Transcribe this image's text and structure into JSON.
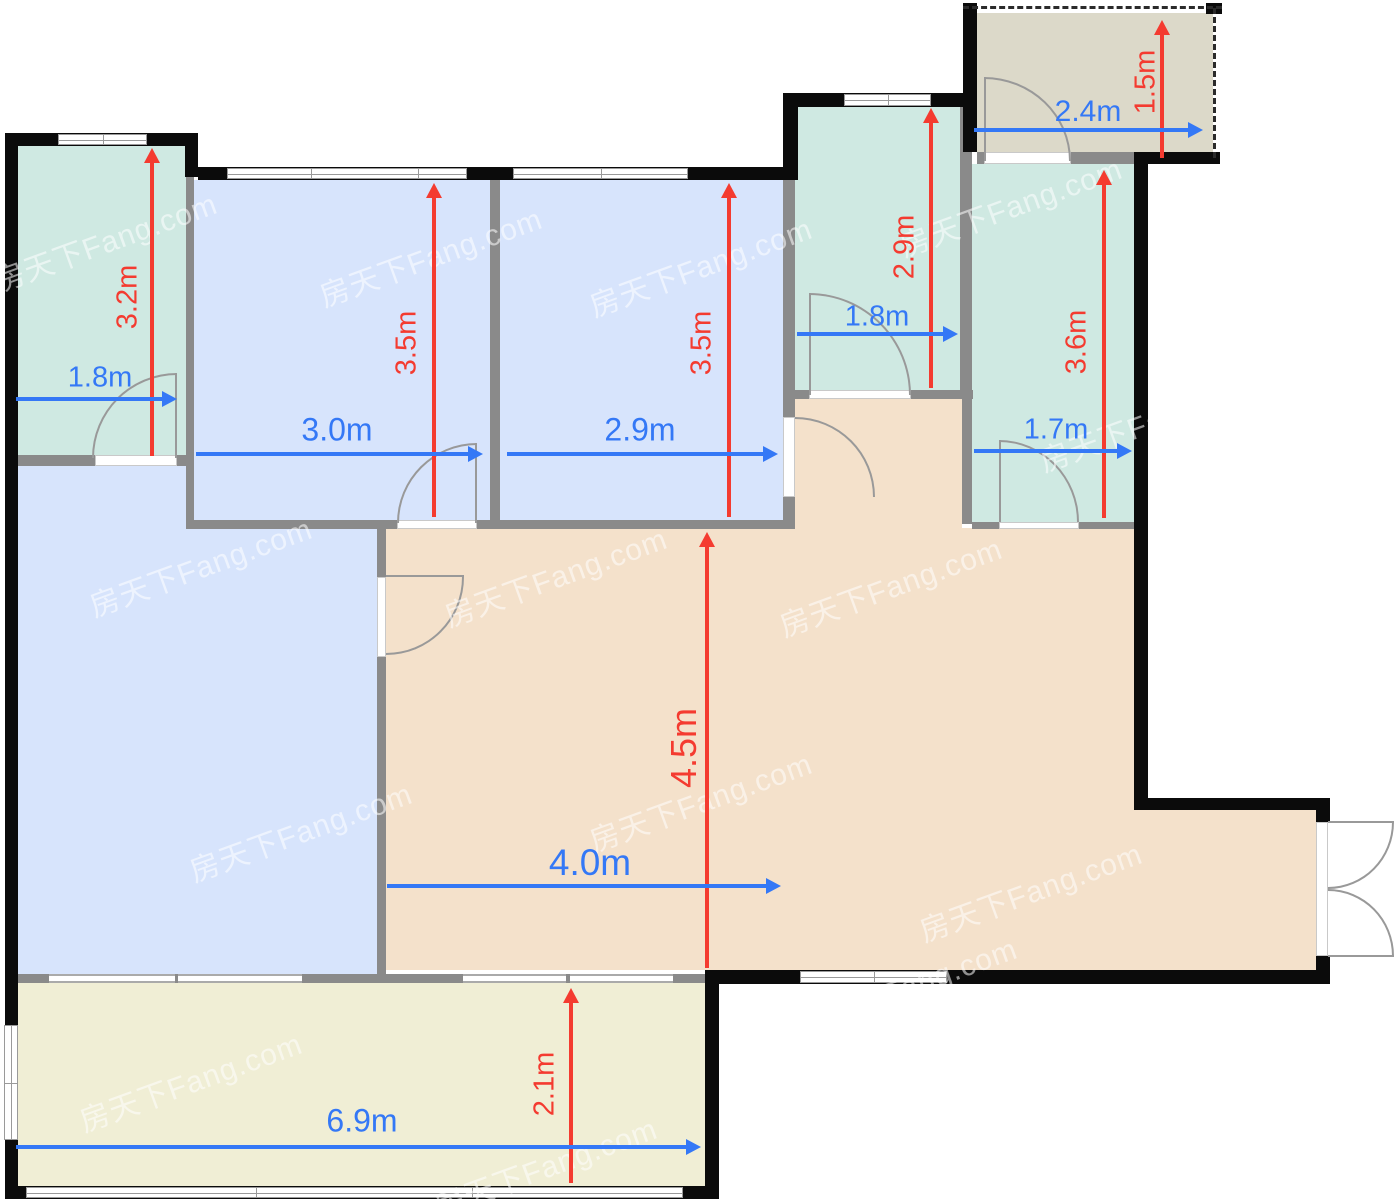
{
  "title": "apartment-floor-plan",
  "watermark": {
    "text": "房天下Fang.com",
    "positions": [
      [
        105,
        240
      ],
      [
        430,
        255
      ],
      [
        700,
        265
      ],
      [
        1010,
        205
      ],
      [
        1150,
        420
      ],
      [
        200,
        565
      ],
      [
        555,
        575
      ],
      [
        890,
        585
      ],
      [
        300,
        830
      ],
      [
        700,
        800
      ],
      [
        1030,
        890
      ],
      [
        190,
        1080
      ],
      [
        545,
        1165
      ],
      [
        905,
        985
      ]
    ]
  },
  "palette": {
    "teal": "#cfe9e2",
    "blue": "#d7e4fc",
    "tan": "#f4e1cb",
    "yellow": "#f0eed5",
    "gray": "#dcd9c9",
    "wall_black": "#0b0b0b",
    "wall_gray": "#8a8a8a",
    "dim_red": "#f43b30",
    "dim_blue": "#3478f6"
  },
  "plan": {
    "width": 1400,
    "height": 1199,
    "rooms": [
      {
        "n": "room-north-bedroom",
        "x": 18,
        "y": 146,
        "w": 168,
        "h": 309,
        "c": "teal"
      },
      {
        "n": "room-bedroom-1",
        "x": 194,
        "y": 180,
        "w": 296,
        "h": 340,
        "c": "blue"
      },
      {
        "n": "room-bedroom-2",
        "x": 500,
        "y": 180,
        "w": 283,
        "h": 340,
        "c": "blue"
      },
      {
        "n": "room-bathroom-a",
        "x": 795,
        "y": 107,
        "w": 165,
        "h": 283,
        "c": "teal"
      },
      {
        "n": "room-entry-porch",
        "x": 977,
        "y": 13,
        "w": 236,
        "h": 139,
        "c": "gray"
      },
      {
        "n": "room-bathroom-b",
        "x": 972,
        "y": 164,
        "w": 162,
        "h": 358,
        "c": "teal"
      },
      {
        "n": "room-living-west",
        "x": 18,
        "y": 465,
        "w": 168,
        "h": 510,
        "c": "blue"
      },
      {
        "n": "room-living-west2",
        "x": 186,
        "y": 529,
        "w": 191,
        "h": 446,
        "c": "blue"
      },
      {
        "n": "room-hallway",
        "x": 795,
        "y": 399,
        "w": 167,
        "h": 129,
        "c": "tan"
      },
      {
        "n": "room-dining",
        "x": 386,
        "y": 528,
        "w": 748,
        "h": 442,
        "c": "tan"
      },
      {
        "n": "room-dining-east",
        "x": 1134,
        "y": 810,
        "w": 182,
        "h": 160,
        "c": "tan"
      },
      {
        "n": "room-balcony",
        "x": 18,
        "y": 983,
        "w": 687,
        "h": 203,
        "c": "yellow"
      }
    ],
    "walls_gray": [
      {
        "x": 186,
        "y": 177,
        "w": 8,
        "h": 352
      },
      {
        "x": 18,
        "y": 455,
        "w": 77,
        "h": 11
      },
      {
        "x": 177,
        "y": 455,
        "w": 11,
        "h": 11
      },
      {
        "x": 186,
        "y": 520,
        "w": 211,
        "h": 9
      },
      {
        "x": 477,
        "y": 520,
        "w": 15,
        "h": 9
      },
      {
        "x": 490,
        "y": 168,
        "w": 10,
        "h": 361
      },
      {
        "x": 490,
        "y": 520,
        "w": 305,
        "h": 9
      },
      {
        "x": 783,
        "y": 168,
        "w": 12,
        "h": 249
      },
      {
        "x": 783,
        "y": 497,
        "w": 12,
        "h": 31
      },
      {
        "x": 960,
        "y": 107,
        "w": 12,
        "h": 283
      },
      {
        "x": 962,
        "y": 390,
        "w": 10,
        "h": 134
      },
      {
        "x": 783,
        "y": 390,
        "w": 26,
        "h": 9
      },
      {
        "x": 911,
        "y": 390,
        "w": 62,
        "h": 9
      },
      {
        "x": 977,
        "y": 152,
        "w": 7,
        "h": 12
      },
      {
        "x": 1071,
        "y": 152,
        "w": 64,
        "h": 12
      },
      {
        "x": 972,
        "y": 522,
        "w": 27,
        "h": 7
      },
      {
        "x": 1079,
        "y": 522,
        "w": 55,
        "h": 7
      },
      {
        "x": 377,
        "y": 529,
        "w": 9,
        "h": 48
      },
      {
        "x": 377,
        "y": 657,
        "w": 9,
        "h": 318
      },
      {
        "x": 8,
        "y": 974,
        "w": 700,
        "h": 9
      }
    ],
    "walls_black": [
      {
        "x": 5,
        "y": 133,
        "w": 13,
        "h": 1066
      },
      {
        "x": 5,
        "y": 133,
        "w": 193,
        "h": 13
      },
      {
        "x": 185,
        "y": 133,
        "w": 13,
        "h": 44
      },
      {
        "x": 198,
        "y": 167,
        "w": 600,
        "h": 13
      },
      {
        "x": 783,
        "y": 93,
        "w": 15,
        "h": 85
      },
      {
        "x": 790,
        "y": 93,
        "w": 183,
        "h": 14
      },
      {
        "x": 963,
        "y": 3,
        "w": 14,
        "h": 149
      },
      {
        "x": 1134,
        "y": 152,
        "w": 86,
        "h": 12
      },
      {
        "x": 1134,
        "y": 152,
        "w": 14,
        "h": 658
      },
      {
        "x": 1134,
        "y": 798,
        "w": 196,
        "h": 12
      },
      {
        "x": 1316,
        "y": 810,
        "w": 14,
        "h": 12
      },
      {
        "x": 1316,
        "y": 956,
        "w": 14,
        "h": 28
      },
      {
        "x": 705,
        "y": 970,
        "w": 625,
        "h": 14
      },
      {
        "x": 705,
        "y": 970,
        "w": 14,
        "h": 229
      },
      {
        "x": 5,
        "y": 1186,
        "w": 714,
        "h": 13
      },
      {
        "x": 1206,
        "y": 3,
        "w": 16,
        "h": 11
      }
    ],
    "windows": [
      {
        "n": "window-north-bedroom",
        "x": 58,
        "y": 134,
        "w": 89,
        "h": 11,
        "o": "h",
        "div": [
          0.5
        ]
      },
      {
        "n": "window-bedroom-1",
        "x": 227,
        "y": 168,
        "w": 240,
        "h": 11,
        "o": "h",
        "div": [
          0.35,
          0.8
        ]
      },
      {
        "n": "window-bedroom-2",
        "x": 513,
        "y": 168,
        "w": 175,
        "h": 11,
        "o": "h",
        "div": [
          0.5
        ]
      },
      {
        "n": "window-bathroom-a",
        "x": 844,
        "y": 94,
        "w": 87,
        "h": 12,
        "o": "h",
        "div": [
          0.5
        ]
      },
      {
        "n": "window-dining-south",
        "x": 800,
        "y": 971,
        "w": 147,
        "h": 12,
        "o": "h",
        "div": [
          0.5
        ]
      },
      {
        "n": "window-balcony-south",
        "x": 26,
        "y": 1187,
        "w": 657,
        "h": 11,
        "o": "h",
        "div": [
          0.35,
          0.68
        ]
      },
      {
        "n": "window-balcony-west",
        "x": 4,
        "y": 1025,
        "w": 14,
        "h": 115,
        "o": "v",
        "div": [
          0.5
        ]
      }
    ],
    "window_segments": [
      {
        "x": 49,
        "y": 974,
        "w": 126,
        "h": 9
      },
      {
        "x": 178,
        "y": 974,
        "w": 124,
        "h": 9
      },
      {
        "x": 463,
        "y": 974,
        "w": 103,
        "h": 9
      },
      {
        "x": 570,
        "y": 974,
        "w": 103,
        "h": 9
      }
    ],
    "door_openings": [
      {
        "n": "door-opening-north-bedroom",
        "x": 95,
        "y": 455,
        "w": 82,
        "h": 11
      },
      {
        "n": "door-opening-bedroom-1",
        "x": 397,
        "y": 520,
        "w": 80,
        "h": 9
      },
      {
        "n": "door-opening-bedroom-2",
        "x": 783,
        "y": 417,
        "w": 12,
        "h": 80
      },
      {
        "n": "door-opening-bathroom-a",
        "x": 809,
        "y": 390,
        "w": 102,
        "h": 9
      },
      {
        "n": "door-opening-porch",
        "x": 984,
        "y": 152,
        "w": 87,
        "h": 12
      },
      {
        "n": "door-opening-bathroom-b",
        "x": 999,
        "y": 522,
        "w": 80,
        "h": 7
      },
      {
        "n": "door-opening-living",
        "x": 377,
        "y": 577,
        "w": 9,
        "h": 80
      },
      {
        "n": "door-opening-entry",
        "x": 1316,
        "y": 822,
        "w": 12,
        "h": 134
      }
    ],
    "door_arcs": [
      {
        "n": "door-arc-north-bedroom",
        "x": 92,
        "y": 373,
        "w": 85,
        "h": 85,
        "corner": "tl"
      },
      {
        "n": "door-arc-bedroom-1",
        "x": 397,
        "y": 443,
        "w": 80,
        "h": 80,
        "corner": "tl"
      },
      {
        "n": "door-arc-bedroom-2",
        "x": 795,
        "y": 417,
        "w": 80,
        "h": 80,
        "corner": "tr"
      },
      {
        "n": "door-arc-bathroom-a",
        "x": 809,
        "y": 293,
        "w": 102,
        "h": 102,
        "corner": "tr"
      },
      {
        "n": "door-arc-porch",
        "x": 984,
        "y": 77,
        "w": 87,
        "h": 84,
        "corner": "tr"
      },
      {
        "n": "door-arc-bathroom-b",
        "x": 999,
        "y": 440,
        "w": 80,
        "h": 82,
        "corner": "tr"
      },
      {
        "n": "door-arc-living",
        "x": 386,
        "y": 577,
        "w": 78,
        "h": 78,
        "corner": "br"
      },
      {
        "n": "door-arc-entry-top",
        "x": 1328,
        "y": 822,
        "w": 66,
        "h": 67,
        "corner": "br"
      },
      {
        "n": "door-arc-entry-bottom",
        "x": 1328,
        "y": 889,
        "w": 66,
        "h": 67,
        "corner": "tr"
      }
    ],
    "door_panels": [
      {
        "x": 175,
        "y": 373,
        "w": 2,
        "h": 85
      },
      {
        "x": 475,
        "y": 443,
        "w": 2,
        "h": 80
      },
      {
        "x": 809,
        "y": 293,
        "w": 2,
        "h": 102
      },
      {
        "x": 984,
        "y": 77,
        "w": 2,
        "h": 84
      },
      {
        "x": 999,
        "y": 440,
        "w": 2,
        "h": 82
      },
      {
        "x": 386,
        "y": 575,
        "w": 78,
        "h": 2
      },
      {
        "x": 1328,
        "y": 821,
        "w": 66,
        "h": 2
      },
      {
        "x": 1328,
        "y": 955,
        "w": 66,
        "h": 2
      }
    ],
    "dashed_lines": [
      {
        "n": "dashed-porch-top",
        "x": 963,
        "y": 6,
        "len": 259,
        "o": "h"
      },
      {
        "n": "dashed-porch-right",
        "x": 1213,
        "y": 8,
        "len": 150,
        "o": "v"
      }
    ],
    "dimension_arrows": {
      "red": [
        {
          "label": "3.2m",
          "x": 152,
          "y1": 148,
          "y2": 456
        },
        {
          "label": "3.5m",
          "x": 434,
          "y1": 183,
          "y2": 517
        },
        {
          "label": "3.5m",
          "x": 729,
          "y1": 183,
          "y2": 517
        },
        {
          "label": "2.9m",
          "x": 931,
          "y1": 108,
          "y2": 388
        },
        {
          "label": "1.5m",
          "x": 1162,
          "y1": 20,
          "y2": 158
        },
        {
          "label": "3.6m",
          "x": 1104,
          "y1": 170,
          "y2": 518
        },
        {
          "label": "4.5m",
          "x": 707,
          "y1": 532,
          "y2": 968
        },
        {
          "label": "2.1m",
          "x": 571,
          "y1": 988,
          "y2": 1183
        }
      ],
      "blue": [
        {
          "label": "1.8m",
          "y": 399,
          "x1": 16,
          "x2": 177
        },
        {
          "label": "3.0m",
          "y": 454,
          "x1": 196,
          "x2": 483
        },
        {
          "label": "2.9m",
          "y": 454,
          "x1": 507,
          "x2": 778
        },
        {
          "label": "1.8m",
          "y": 334,
          "x1": 797,
          "x2": 958
        },
        {
          "label": "2.4m",
          "y": 130,
          "x1": 974,
          "x2": 1203
        },
        {
          "label": "1.7m",
          "y": 451,
          "x1": 974,
          "x2": 1132
        },
        {
          "label": "4.0m",
          "y": 886,
          "x1": 387,
          "x2": 781
        },
        {
          "label": "6.9m",
          "y": 1147,
          "x1": 16,
          "x2": 701
        }
      ]
    },
    "dimension_labels": [
      {
        "text": "3.2m",
        "x": 128,
        "y": 297,
        "rot": 1,
        "size": 29,
        "color": "red"
      },
      {
        "text": "3.5m",
        "x": 407,
        "y": 343,
        "rot": 1,
        "size": 29,
        "color": "red"
      },
      {
        "text": "3.5m",
        "x": 702,
        "y": 343,
        "rot": 1,
        "size": 29,
        "color": "red"
      },
      {
        "text": "2.9m",
        "x": 905,
        "y": 247,
        "rot": 1,
        "size": 29,
        "color": "red"
      },
      {
        "text": "1.5m",
        "x": 1146,
        "y": 82,
        "rot": 1,
        "size": 29,
        "color": "red"
      },
      {
        "text": "3.6m",
        "x": 1077,
        "y": 342,
        "rot": 1,
        "size": 29,
        "color": "red"
      },
      {
        "text": "4.5m",
        "x": 684,
        "y": 748,
        "rot": 1,
        "size": 36,
        "color": "red"
      },
      {
        "text": "2.1m",
        "x": 545,
        "y": 1084,
        "rot": 1,
        "size": 29,
        "color": "red"
      },
      {
        "text": "1.8m",
        "x": 100,
        "y": 378,
        "rot": 0,
        "size": 29,
        "color": "blue"
      },
      {
        "text": "3.0m",
        "x": 337,
        "y": 430,
        "rot": 0,
        "size": 32,
        "color": "blue"
      },
      {
        "text": "2.9m",
        "x": 640,
        "y": 430,
        "rot": 0,
        "size": 32,
        "color": "blue"
      },
      {
        "text": "1.8m",
        "x": 877,
        "y": 317,
        "rot": 0,
        "size": 29,
        "color": "blue"
      },
      {
        "text": "2.4m",
        "x": 1088,
        "y": 112,
        "rot": 0,
        "size": 30,
        "color": "blue"
      },
      {
        "text": "1.7m",
        "x": 1056,
        "y": 430,
        "rot": 0,
        "size": 29,
        "color": "blue"
      },
      {
        "text": "4.0m",
        "x": 590,
        "y": 863,
        "rot": 0,
        "size": 37,
        "color": "blue"
      },
      {
        "text": "6.9m",
        "x": 362,
        "y": 1121,
        "rot": 0,
        "size": 32,
        "color": "blue"
      }
    ]
  }
}
